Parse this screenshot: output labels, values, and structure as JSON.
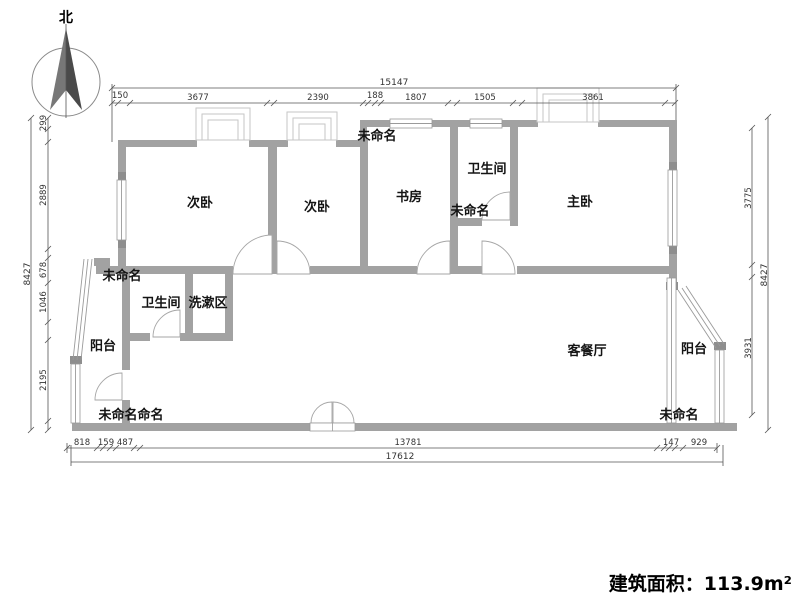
{
  "compass": {
    "label": "北"
  },
  "title": {
    "area": "建筑面积：113.9m²"
  },
  "rooms": {
    "bedroom_left": "次卧",
    "bedroom_mid": "次卧",
    "study": "书房",
    "bathroom_top": "卫生间",
    "master_bedroom": "主卧",
    "living_dining": "客餐厅",
    "bathroom_left": "卫生间",
    "washing_area": "洗漱区",
    "balcony_left": "阳台",
    "balcony_right": "阳台",
    "unnamed_top": "未命名",
    "unnamed_center": "未命名",
    "unnamed_left": "未命名",
    "unnamed_bottom_left": "未命名命名",
    "unnamed_bottom_right": "未命名"
  },
  "dimensions": {
    "top": {
      "total": "15147",
      "segments": [
        "150",
        "3677",
        "2390",
        "188",
        "1807",
        "1505",
        "3861"
      ]
    },
    "left": {
      "total": "8427",
      "segments": [
        "299",
        "2889",
        "678",
        "1046",
        "2195"
      ]
    },
    "right": {
      "total": "8427",
      "segments": [
        "3775",
        "3931"
      ]
    },
    "bottom": {
      "total": "17612",
      "segments": [
        "818",
        "159",
        "487",
        "13781",
        "147",
        "929"
      ]
    }
  }
}
